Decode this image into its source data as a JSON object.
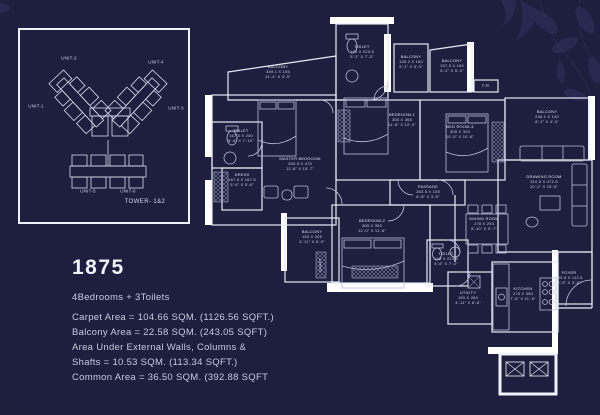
{
  "page": {
    "background_color": "#1e1e3e",
    "line_color": "#e6e9f5",
    "wall_color": "#ffffff",
    "text_color": "#c7cbdf"
  },
  "keyplan": {
    "tower_label": "TOWER- 1&2",
    "units": [
      {
        "label": "UNIT-1"
      },
      {
        "label": "UNIT-2"
      },
      {
        "label": "UNIT-3"
      },
      {
        "label": "UNIT-4"
      },
      {
        "label": "UNIT-5"
      },
      {
        "label": "UNIT-6"
      }
    ]
  },
  "info": {
    "plan_number": "1875",
    "config": "4Bedrooms + 3Toilets",
    "lines": [
      "Carpet Area = 104.66 SQM. (1126.56 SQFT.)",
      "Balcony Area = 22.58 SQM. (243.05 SQFT)",
      "Area Under External Walls, Columns &",
      "Shafts = 10.53 SQM. (113.34 SQFT.)",
      "Common Area = 36.50 SQM. (392.88 SQFT"
    ]
  },
  "floorplan": {
    "rooms": [
      {
        "name": "BALCONY",
        "metric": "349.1 X 105",
        "imperial": "11'-4\" X 3'-5\""
      },
      {
        "name": "TOILET",
        "metric": "155 X 220.5",
        "imperial": "5'-1\" X 7'-3\""
      },
      {
        "name": "BALCONY",
        "metric": "155.2 X 160",
        "imperial": "5'-1\" X 5'-3\""
      },
      {
        "name": "BALCONY",
        "metric": "157.5 X 160",
        "imperial": "5'-2\" X 5'-3\""
      },
      {
        "name": "C.B.",
        "metric": "",
        "imperial": ""
      },
      {
        "name": "BALCONY",
        "metric": "246.1 X 130",
        "imperial": "8'-1\" X 4'-3\""
      },
      {
        "name": "MASTER BEDROOM",
        "metric": "350.5 X 475",
        "imperial": "11'-6\" X 15'-7\""
      },
      {
        "name": "TOILET",
        "metric": "167.5 X 240",
        "imperial": "5'-6\" X 7'-10\""
      },
      {
        "name": "DRESS",
        "metric": "167.5 X 167.5",
        "imperial": "5'-6\" X 5'-6\""
      },
      {
        "name": "BEDROOM-1",
        "metric": "350 X 365",
        "imperial": "11'-6\" X 12'-0\""
      },
      {
        "name": "BED ROOM-3",
        "metric": "305 X 320",
        "imperial": "10'-0\" X 10'-6\""
      },
      {
        "name": "DRAWING ROOM",
        "metric": "310.5 X 472.5",
        "imperial": "10'-2\" X 15'-6\""
      },
      {
        "name": "PASSAGE",
        "metric": "263.5 X 105",
        "imperial": "8'-8\" X 3'-5\""
      },
      {
        "name": "DINING ROOM",
        "metric": "178 X 293",
        "imperial": "5'-10\" X 9'-7\""
      },
      {
        "name": "BEDROOM-2",
        "metric": "365 X 350",
        "imperial": "12'-0\" X 11'-6\""
      },
      {
        "name": "BALCONY",
        "metric": "150 X 205",
        "imperial": "4'-11\" X 6'-9\""
      },
      {
        "name": "TOILET",
        "metric": "168 X 223.5",
        "imperial": "5'-6\" X 7'-4\""
      },
      {
        "name": "UTILITY",
        "metric": "150 X 260",
        "imperial": "4'-11\" X 8'-6\""
      },
      {
        "name": "KITCHEN",
        "metric": "275 X 350",
        "imperial": "7'-6\" X 11'-6\""
      },
      {
        "name": "FOYER",
        "metric": "105.5 X 112.5",
        "imperial": "3'-5\" X 3'-8\""
      },
      {
        "name": "SHAFT",
        "metric": "",
        "imperial": ""
      }
    ]
  }
}
